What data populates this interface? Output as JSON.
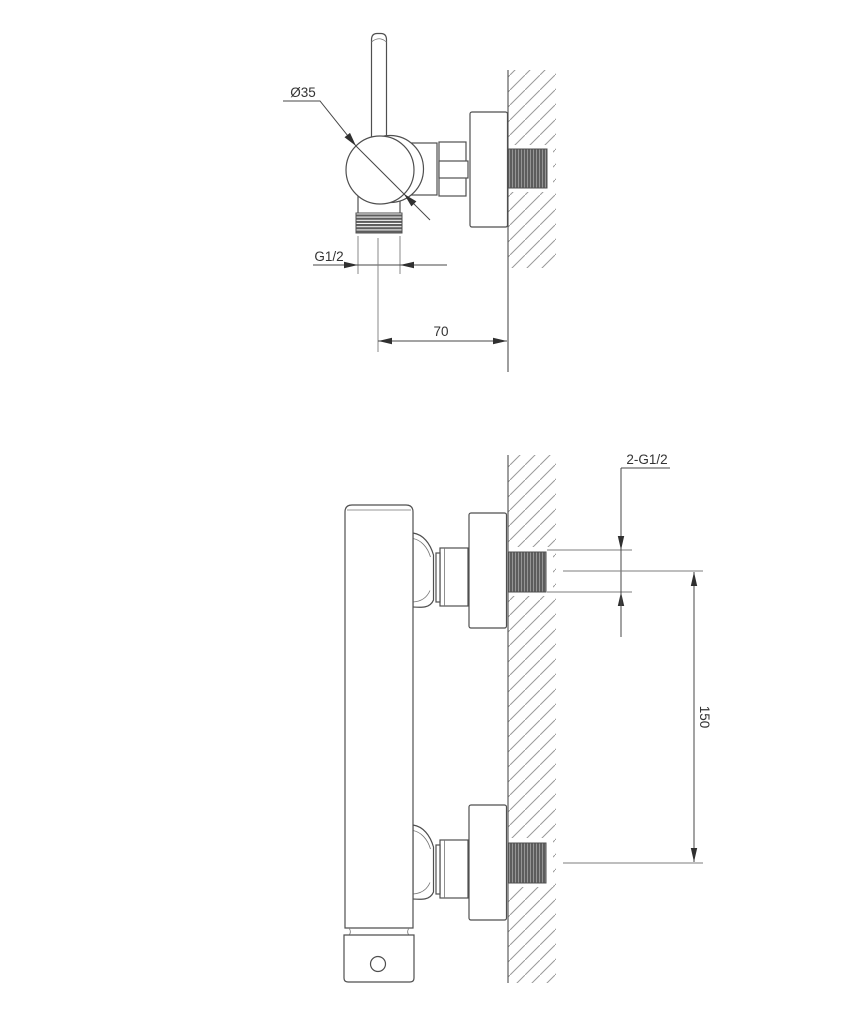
{
  "colors": {
    "background": "#ffffff",
    "outline": "#4f4f4f",
    "dimension_line": "#474747",
    "extension_line": "#7d7d7d",
    "hatch": "#9a9a9a",
    "thread_fill": "#5d5d5d",
    "label_text": "#333333"
  },
  "top_view": {
    "labels": {
      "body_diameter": "Ø35",
      "outlet_thread": "G1/2",
      "wall_distance": "70"
    }
  },
  "bottom_view": {
    "labels": {
      "wall_connections": "2-G1/2",
      "connection_spacing": "150"
    }
  }
}
